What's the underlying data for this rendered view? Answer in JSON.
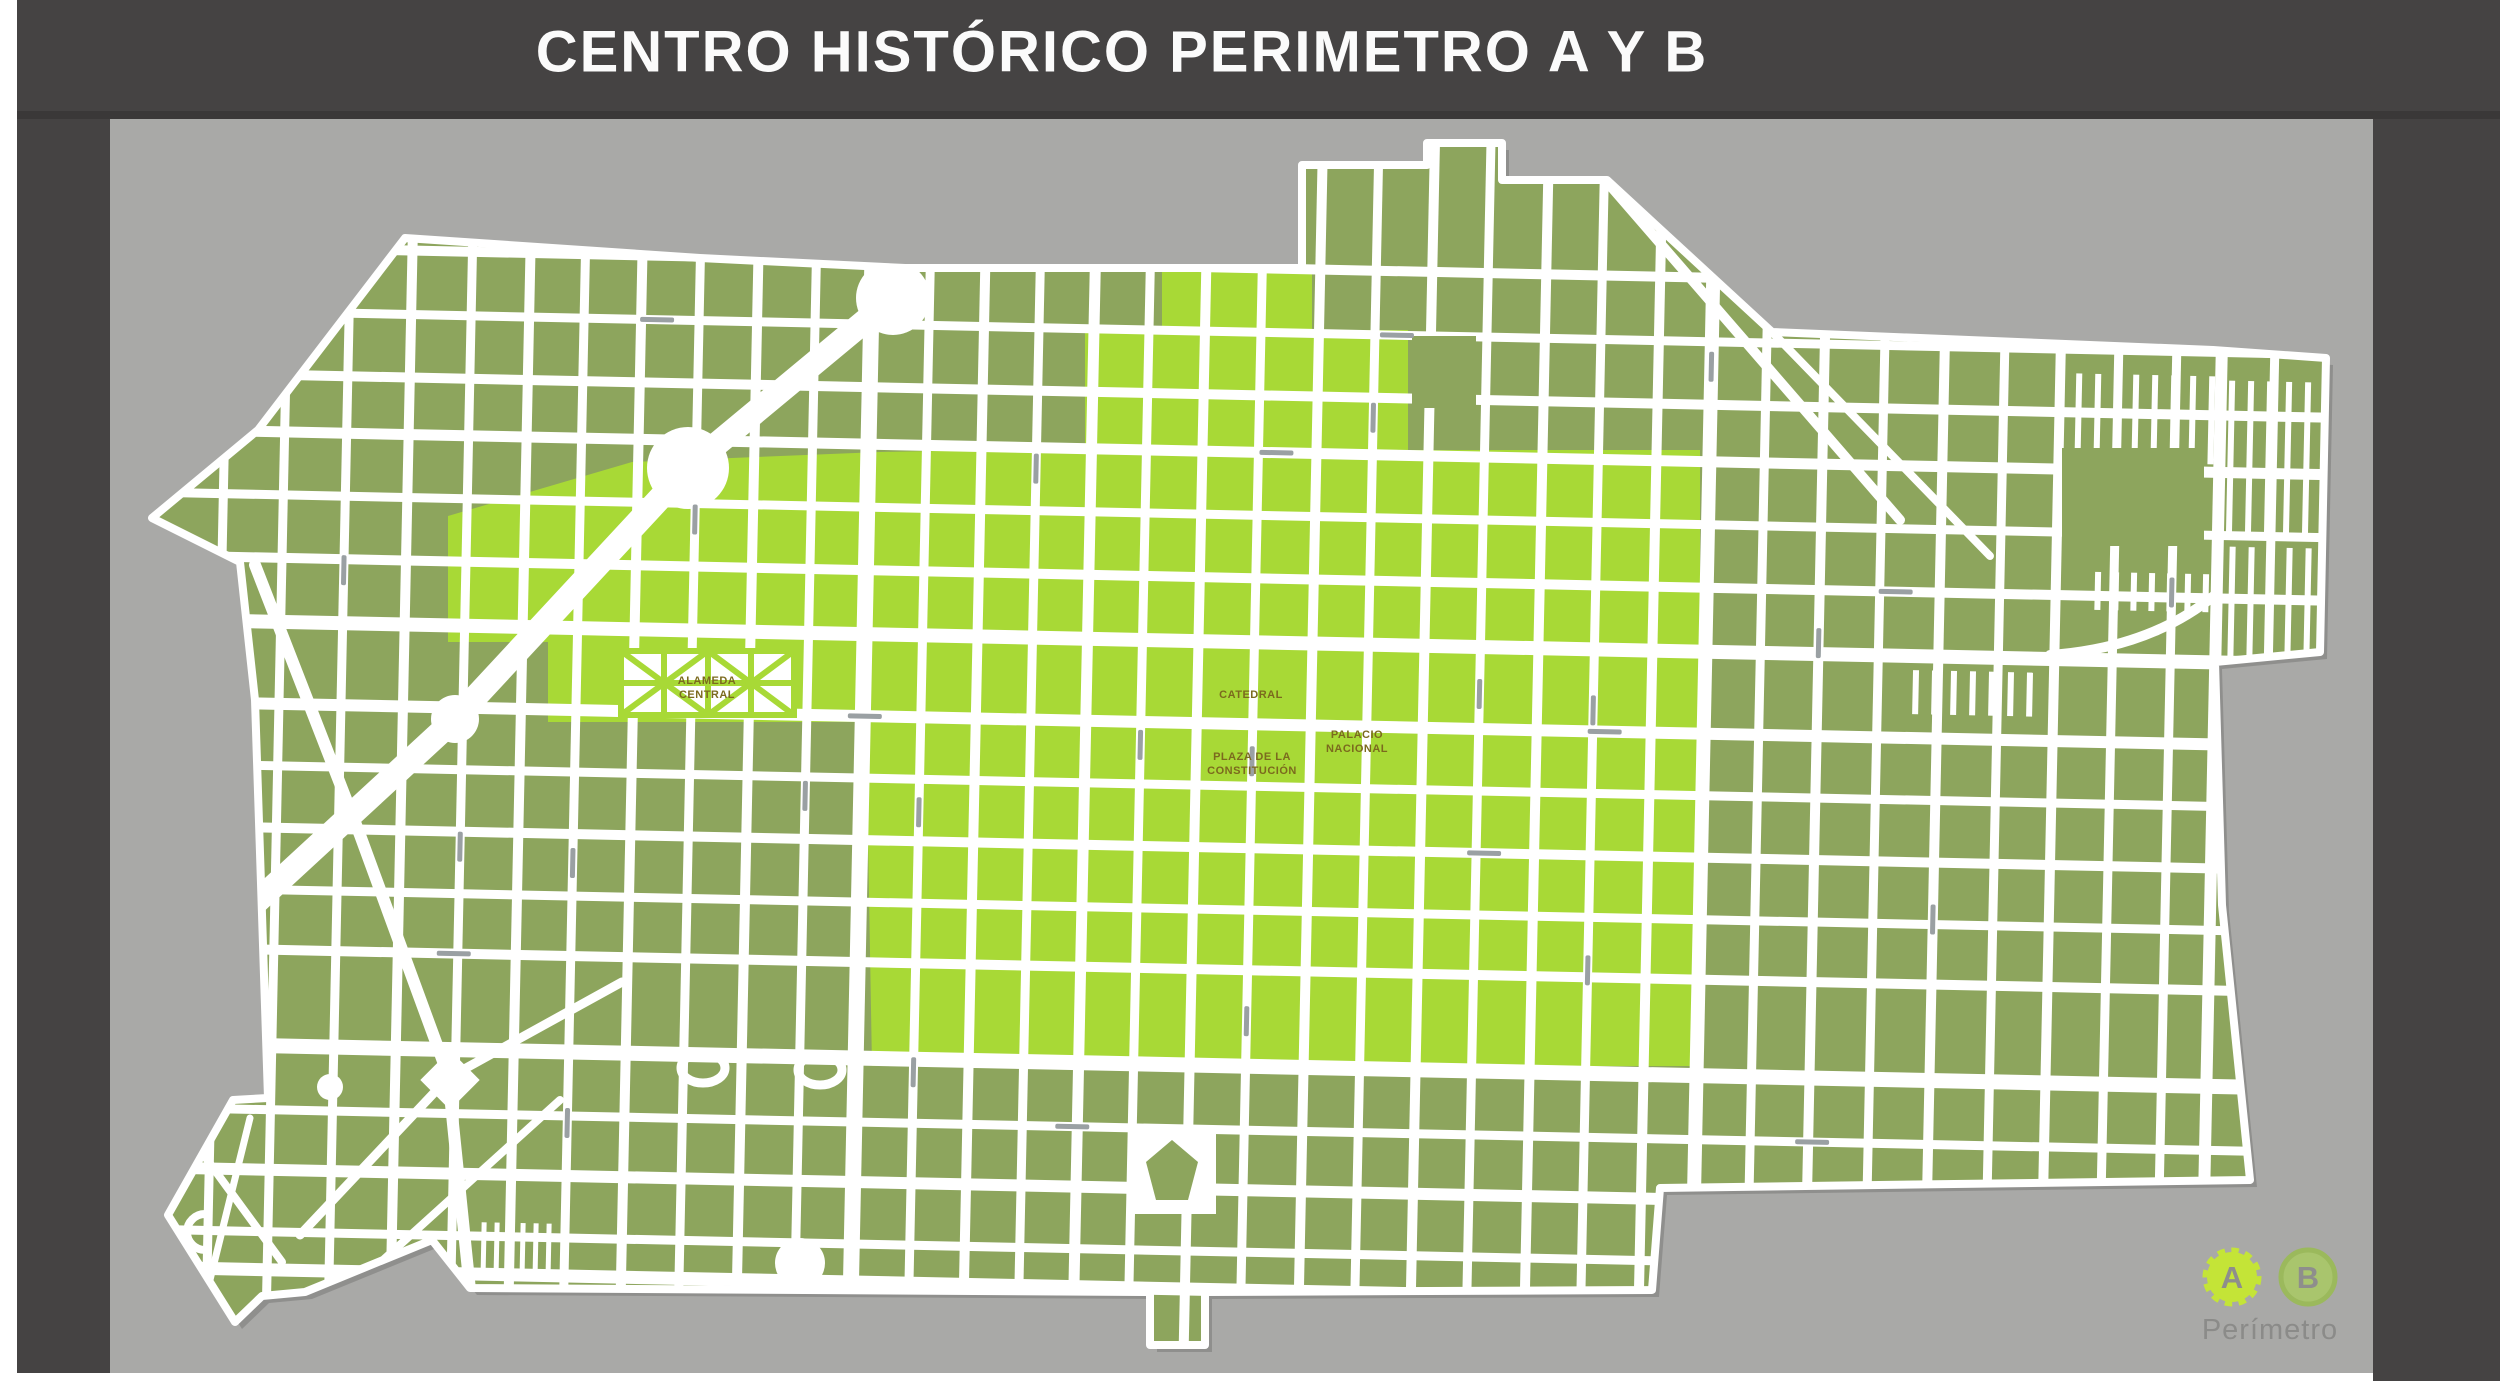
{
  "header": {
    "title": "CENTRO HISTÓRICO PERIMETRO A Y B"
  },
  "legend": {
    "badge_a": "A",
    "badge_b": "B",
    "caption": "Perímetro"
  },
  "map": {
    "landmarks": {
      "alameda": {
        "line1": "ALAMEDA",
        "line2": "CENTRAL"
      },
      "catedral": {
        "line1": "CATEDRAL"
      },
      "zocalo": {
        "line1": "PLAZA DE LA",
        "line2": "CONSTITUCIÓN"
      },
      "palacio": {
        "line1": "PALACIO",
        "line2": "NACIONAL"
      }
    },
    "colors": {
      "perimeter_a": "#a8d936",
      "perimeter_b": "#8da55d",
      "street": "#ffffff",
      "panel": "#a9a9a7",
      "frame": "#454343",
      "seam": "#3a3838",
      "map_shadow": "#8f8f8d",
      "landmark_text": "#7b6a1e",
      "street_label_mark": "#9aa0a3",
      "legend_text": "#8b8b89",
      "badge_a_fill": "#c4e437",
      "badge_b_fill": "#a9c56d",
      "badge_b_ring": "#9bb95c",
      "badge_letter": "#8e8e8c",
      "title_text": "#fbfbfb"
    }
  }
}
